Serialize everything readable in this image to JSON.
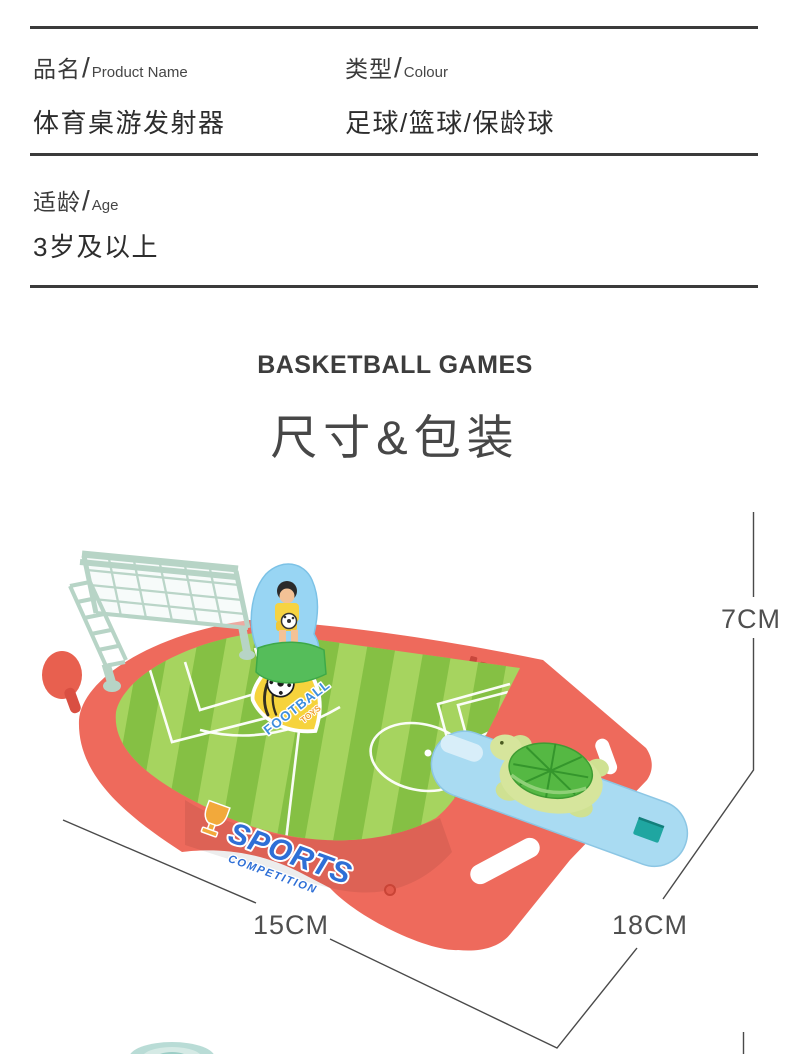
{
  "specs": {
    "sep": "/",
    "product_name": {
      "label_cn": "品名",
      "label_en": "Product Name",
      "value": "体育桌游发射器"
    },
    "colour": {
      "label_cn": "类型",
      "label_en": "Colour",
      "value": "足球/篮球/保龄球"
    },
    "age": {
      "label_cn": "适龄",
      "label_en": "Age",
      "value": "3岁及以上"
    }
  },
  "section": {
    "eyebrow": "BASKETBALL GAMES",
    "title": "尺寸&包装"
  },
  "dimensions": {
    "height": "7CM",
    "width": "15CM",
    "depth": "18CM"
  },
  "toy": {
    "badge": {
      "line1": "FOOTBALL",
      "line2": "TOYS"
    },
    "sticker": {
      "line1": "SPORTS",
      "line2": "COMPETITION"
    }
  },
  "colors": {
    "base_coral": "#ee6a5c",
    "base_coral_dark": "#d94f42",
    "field_light": "#a6d45f",
    "field_dark": "#85c044",
    "goal_mint": "#b7d4c6",
    "launcher_blue": "#a9dbf2",
    "launcher_hole_teal": "#1fa6a1",
    "turtle_shell": "#55b843",
    "turtle_body": "#d6e59c",
    "badge_yellow": "#f6d33c",
    "badge_blue": "#3d8edd",
    "sticker_blue": "#2e6fd6",
    "trophy_orange": "#f2a93b",
    "keeper_sign_blue": "#98d5f3",
    "dimension_gray": "#4a4a4a",
    "rule_dark": "#3b3b3b"
  }
}
